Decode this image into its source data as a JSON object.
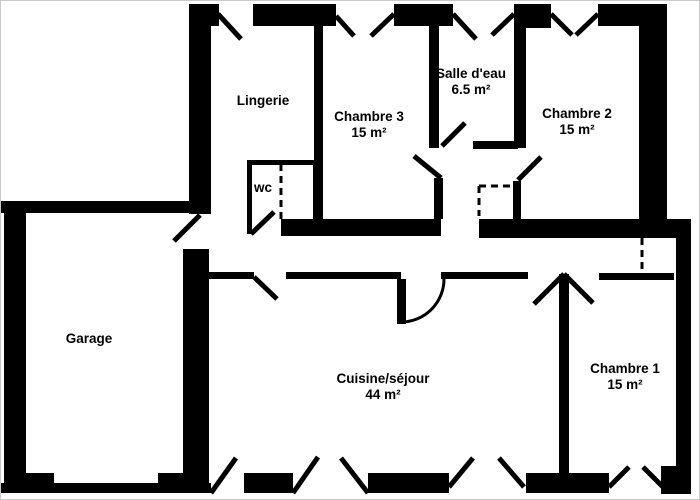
{
  "canvas": {
    "width": 700,
    "height": 500
  },
  "colors": {
    "wall": "#000000",
    "background": "#ffffff",
    "frame": "#c9c9c9"
  },
  "rooms": [
    {
      "name": "Lingerie",
      "area": null,
      "label_x": 262,
      "label_y": 100
    },
    {
      "name": "Chambre 3",
      "area": "15 m²",
      "label_x": 368,
      "label_y": 124
    },
    {
      "name": "Salle d'eau",
      "area": "6.5 m²",
      "label_x": 470,
      "label_y": 81
    },
    {
      "name": "Chambre 2",
      "area": "15 m²",
      "label_x": 576,
      "label_y": 121
    },
    {
      "name": "wc",
      "area": null,
      "label_x": 262,
      "label_y": 187
    },
    {
      "name": "Garage",
      "area": null,
      "label_x": 88,
      "label_y": 338
    },
    {
      "name": "Cuisine/séjour",
      "area": "44 m²",
      "label_x": 382,
      "label_y": 386
    },
    {
      "name": "Chambre 1",
      "area": "15 m²",
      "label_x": 624,
      "label_y": 376
    }
  ],
  "walls": [
    [
      188,
      3,
      30,
      22
    ],
    [
      188,
      3,
      22,
      210
    ],
    [
      252,
      3,
      83,
      22
    ],
    [
      393,
      3,
      59,
      22
    ],
    [
      513,
      3,
      37,
      24
    ],
    [
      597,
      3,
      69,
      22
    ],
    [
      638,
      3,
      28,
      222
    ],
    [
      313,
      25,
      9,
      135
    ],
    [
      246,
      159,
      67,
      5
    ],
    [
      246,
      159,
      5,
      74
    ],
    [
      312,
      160,
      10,
      58
    ],
    [
      280,
      218,
      160,
      17
    ],
    [
      478,
      218,
      198,
      19
    ],
    [
      663,
      218,
      27,
      8
    ],
    [
      428,
      25,
      10,
      122
    ],
    [
      433,
      177,
      9,
      41
    ],
    [
      472,
      140,
      45,
      8
    ],
    [
      513,
      25,
      12,
      122
    ],
    [
      512,
      180,
      8,
      38
    ],
    [
      0,
      200,
      188,
      12
    ],
    [
      3,
      200,
      22,
      292
    ],
    [
      182,
      248,
      26,
      225
    ],
    [
      0,
      482,
      210,
      10
    ],
    [
      3,
      472,
      50,
      20
    ],
    [
      157,
      472,
      51,
      20
    ],
    [
      243,
      472,
      49,
      20
    ],
    [
      367,
      472,
      81,
      20
    ],
    [
      525,
      472,
      83,
      20
    ],
    [
      660,
      465,
      30,
      28
    ],
    [
      675,
      225,
      15,
      252
    ],
    [
      208,
      271,
      45,
      7
    ],
    [
      285,
      271,
      115,
      7
    ],
    [
      440,
      271,
      87,
      7
    ],
    [
      598,
      272,
      75,
      7
    ],
    [
      558,
      273,
      10,
      199
    ]
  ],
  "leaves": [
    [
      217,
      13,
      240,
      38
    ],
    [
      335,
      15,
      353,
      35
    ],
    [
      393,
      13,
      370,
      35
    ],
    [
      452,
      13,
      475,
      38
    ],
    [
      513,
      13,
      491,
      34
    ],
    [
      550,
      13,
      571,
      34
    ],
    [
      597,
      13,
      575,
      34
    ],
    [
      250,
      233,
      273,
      211
    ],
    [
      440,
      177,
      413,
      155
    ],
    [
      441,
      145,
      464,
      122
    ],
    [
      517,
      179,
      540,
      156
    ],
    [
      199,
      214,
      173,
      240
    ],
    [
      253,
      276,
      276,
      298
    ],
    [
      563,
      273,
      533,
      303
    ],
    [
      563,
      273,
      592,
      302
    ],
    [
      210,
      492,
      235,
      457
    ],
    [
      292,
      492,
      317,
      456
    ],
    [
      340,
      457,
      367,
      492
    ],
    [
      448,
      486,
      472,
      457
    ],
    [
      498,
      457,
      523,
      486
    ],
    [
      608,
      486,
      628,
      466
    ],
    [
      642,
      466,
      663,
      487
    ]
  ],
  "dashed": [
    [
      280,
      163,
      280,
      218
    ],
    [
      478,
      185,
      513,
      185
    ],
    [
      478,
      185,
      478,
      215
    ],
    [
      641,
      237,
      641,
      272
    ]
  ],
  "door_arc": {
    "leaf": [
      396,
      278,
      9,
      45
    ],
    "path": "M 443 278 A 43 43 0 0 1 400 321"
  }
}
